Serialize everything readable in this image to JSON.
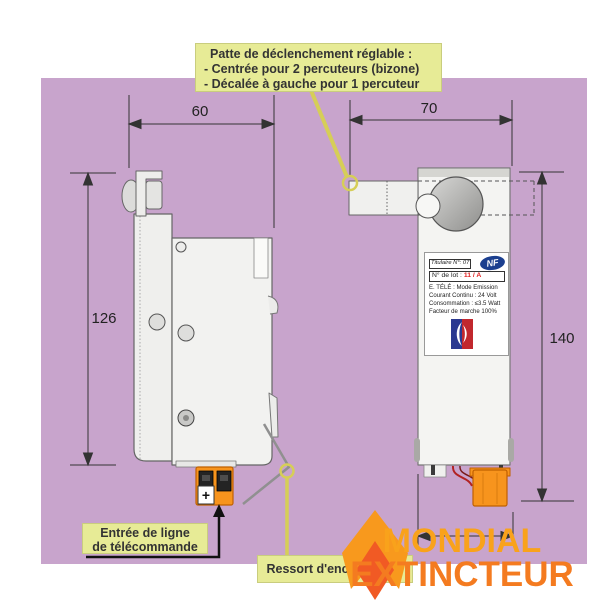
{
  "callouts": {
    "patte": {
      "title": "Patte de déclenchement réglable :",
      "line1": "- Centrée pour 2 percuteurs (bizone)",
      "line2": "- Décalée à gauche pour 1 percuteur"
    },
    "entree": {
      "line1": "Entrée de ligne",
      "line2": "de télécommande"
    },
    "ressort": {
      "label": "Ressort d'encliquetage"
    }
  },
  "dimensions": {
    "width_left_view": "60",
    "width_right_view": "70",
    "height_left_view": "126",
    "height_right_view": "140"
  },
  "device_label": {
    "titulaire": "Titulaire N°: 07",
    "lot_label": "N° de lot :",
    "lot_value": "11 / A",
    "nf": "NF",
    "line1": "E. TÉLÉ : Mode Emission",
    "line2": "Courant Continu : 24 Volt",
    "line3": "Consommation : ≤3.5 Watt",
    "line4": "Facteur de marche 100%"
  },
  "connector": {
    "plus": "+"
  },
  "brand": {
    "line1": "MONDIAL",
    "line2": "EXTINCTEUR"
  },
  "colors": {
    "panel": "#C8A4CC",
    "callout_box": "#E7EB96",
    "callout_line": "#D6CE57",
    "connector_orange": "#F7941D",
    "flame_outer": "#F8991D",
    "flame_inner": "#F15A24",
    "brand_line1": "#F9A21B",
    "brand_line2": "#F47B20",
    "nf_blue": "#1B3F8F",
    "lot_red": "#E02020"
  }
}
